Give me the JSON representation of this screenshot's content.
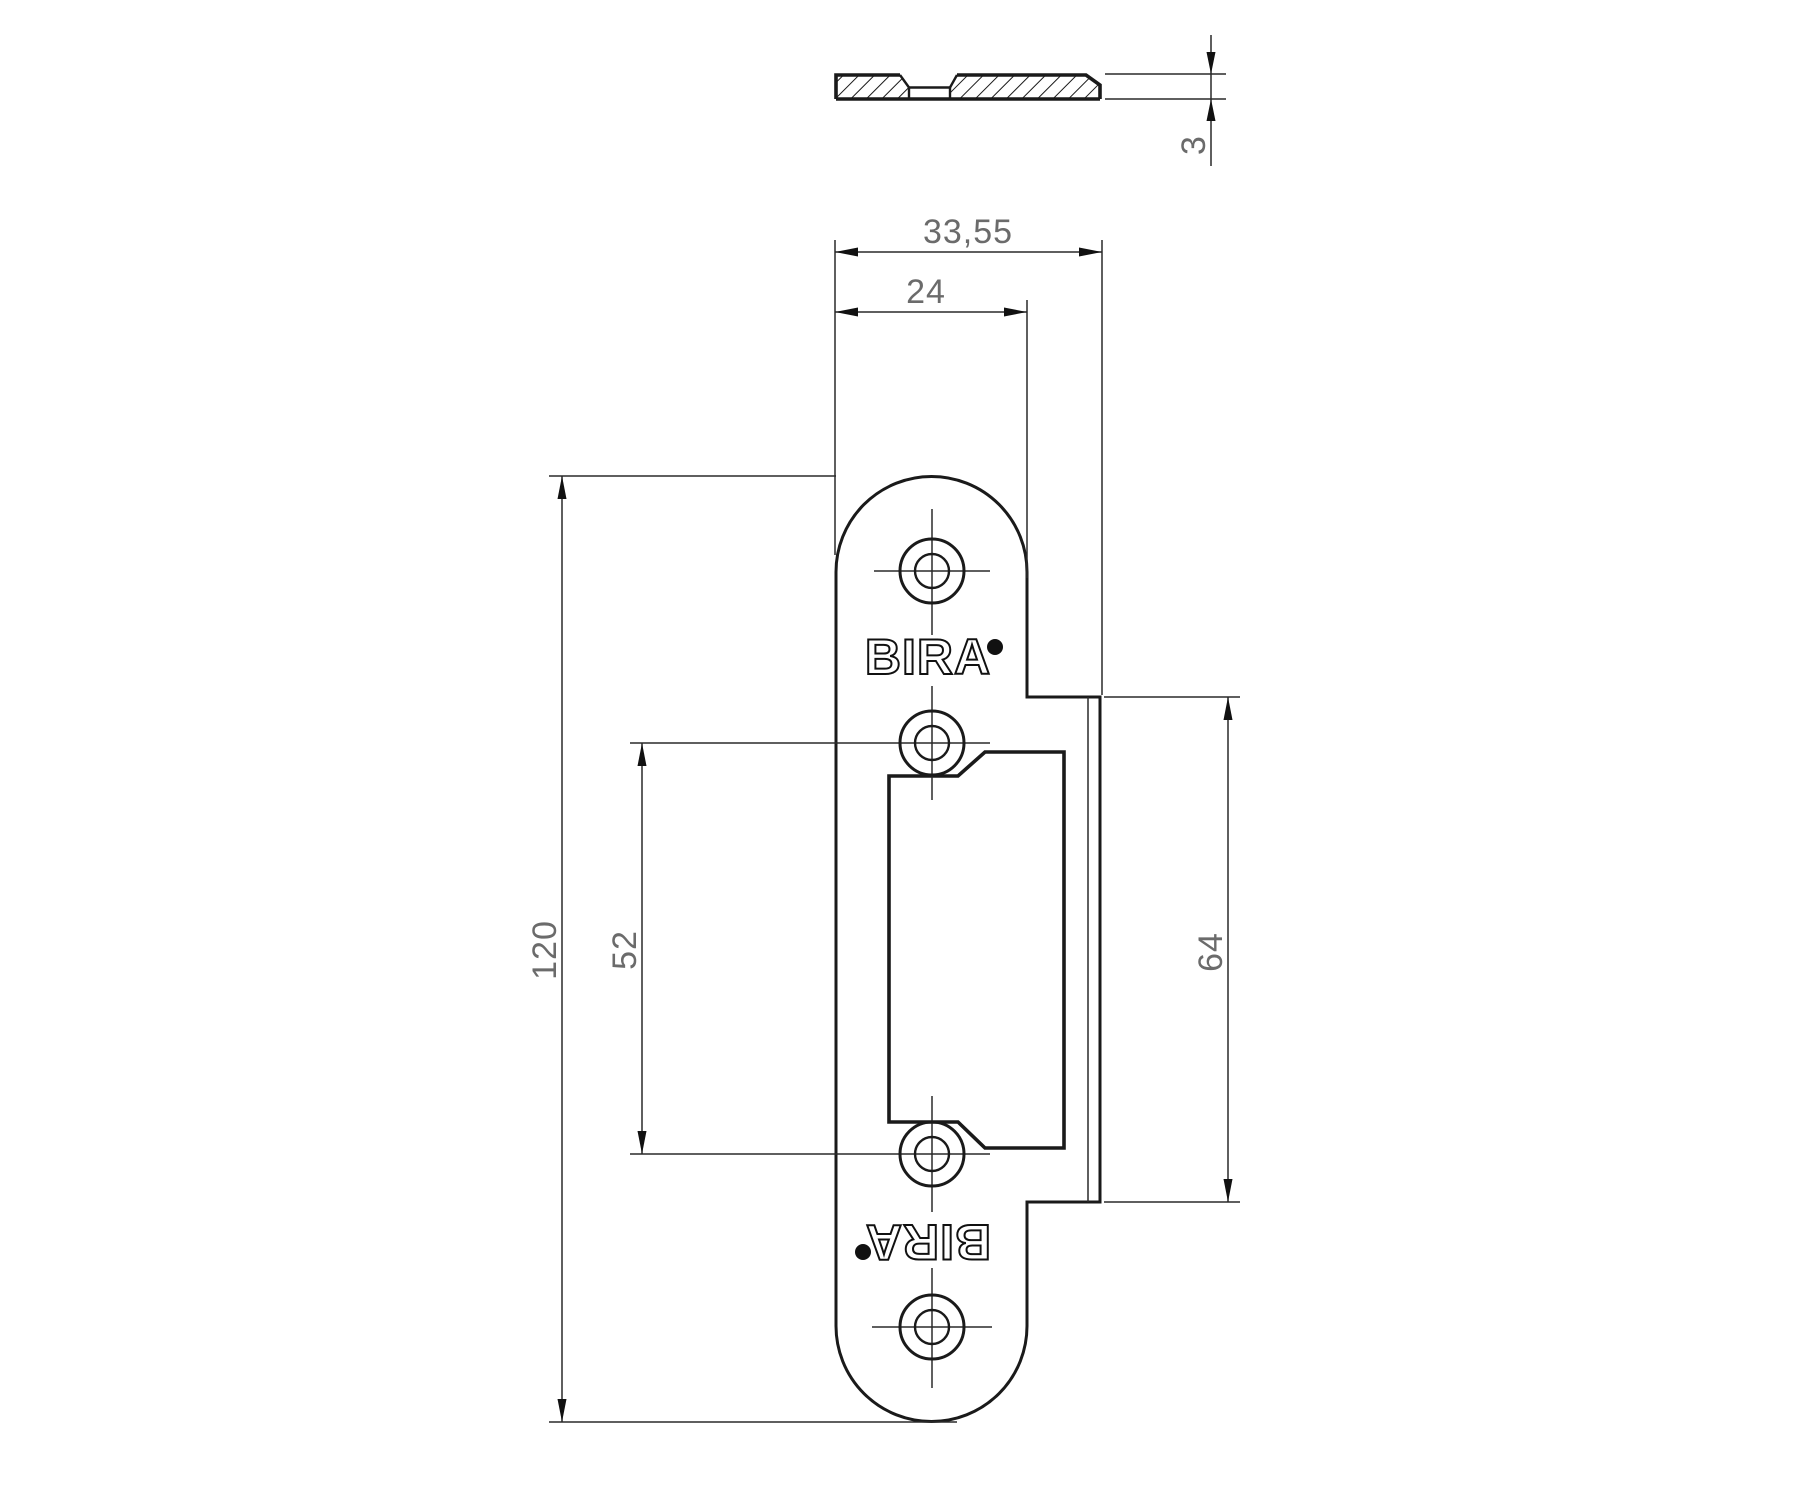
{
  "brand": {
    "name": "BIRA"
  },
  "dimensions": {
    "thickness": "3",
    "overall_width": "33,55",
    "body_width": "24",
    "body_height": "120",
    "hole_spacing": "52",
    "lip_length": "64"
  }
}
